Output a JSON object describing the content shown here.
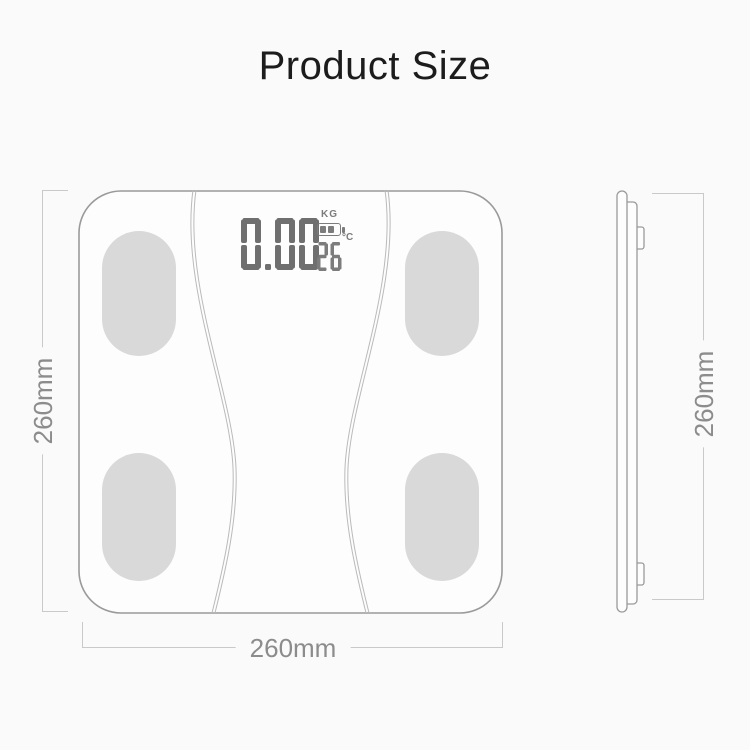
{
  "title": "Product Size",
  "front_view": {
    "display": {
      "weight": "0.00",
      "weight_unit": "KG",
      "temperature": "26",
      "temperature_unit": "°C"
    },
    "dimensions": {
      "height": "260mm",
      "width": "260mm"
    }
  },
  "side_view": {
    "dimensions": {
      "height": "260mm"
    }
  },
  "colors": {
    "background": "#fafafa",
    "scale_outline": "#9a9a9a",
    "scale_surface": "#fdfdfd",
    "electrode_pad": "#d9d9d9",
    "body_curve": "#bababa",
    "lcd_digits": "#6f6f6f",
    "lcd_icons": "#7c7c7c",
    "dimension_line": "#c9c9c9",
    "dimension_text": "#8c8c8c",
    "title_text": "#1c1c1c"
  }
}
